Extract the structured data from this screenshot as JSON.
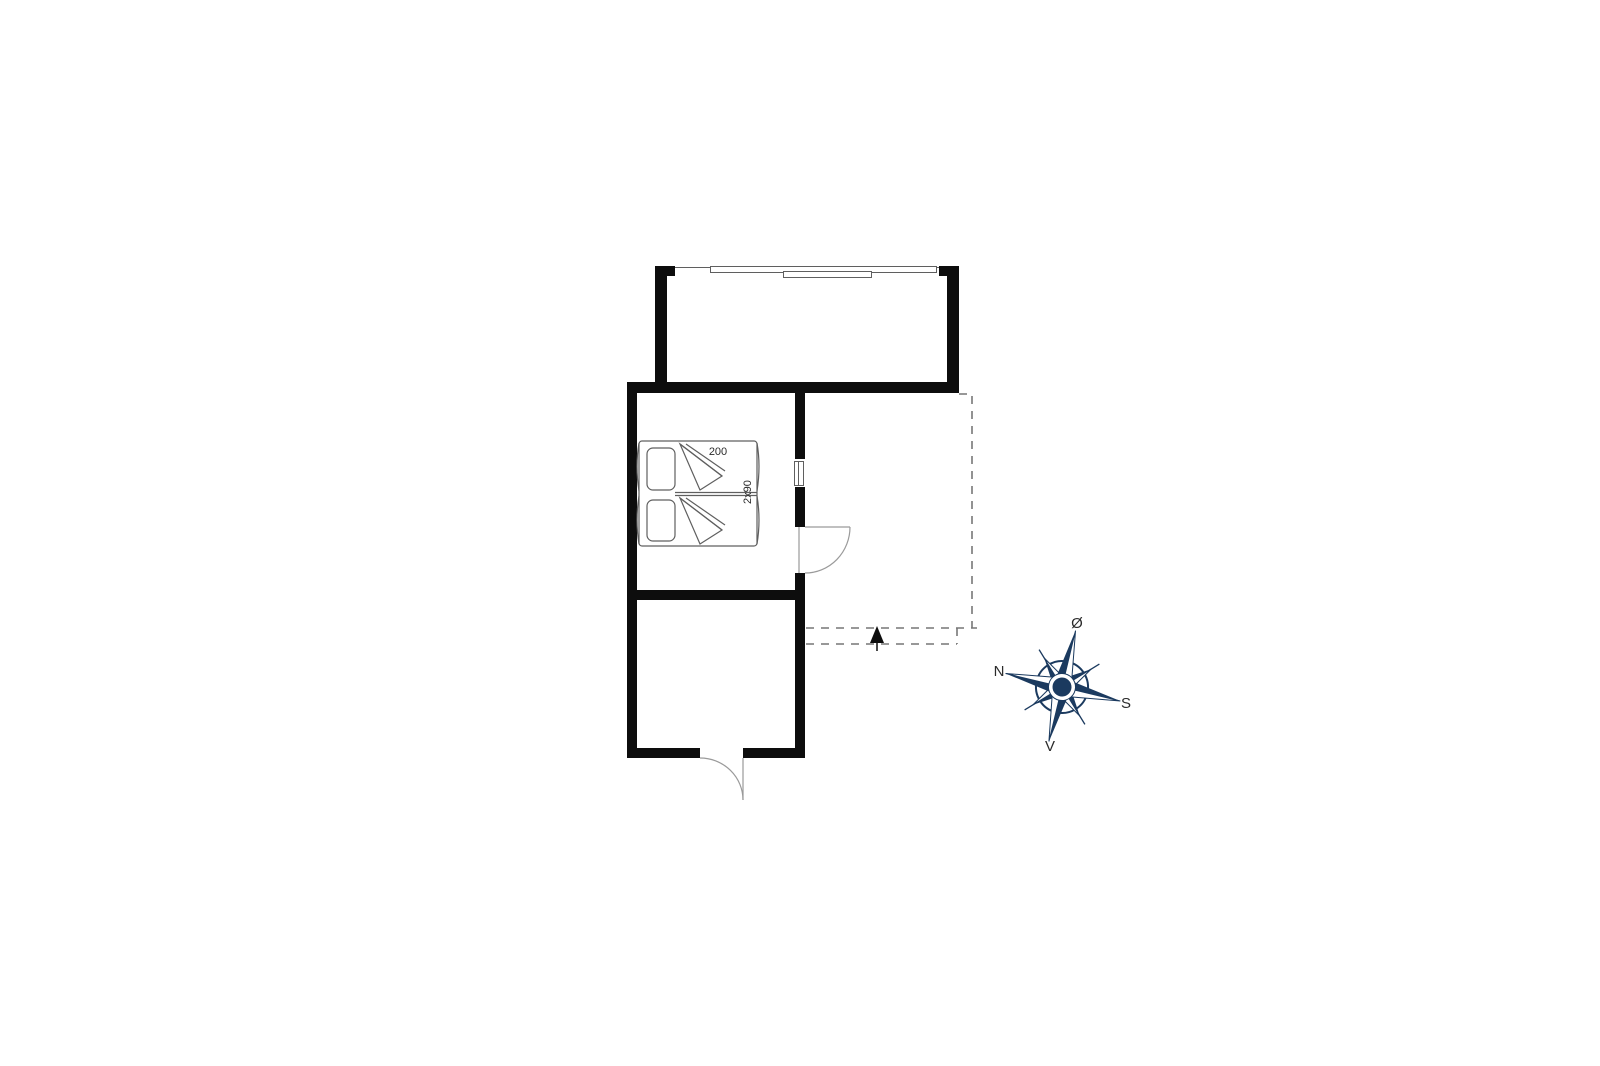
{
  "colors": {
    "background": "#ffffff",
    "wall": "#0d0d0d",
    "line": "#5f5f5f",
    "light-line": "#9a9a9a",
    "dashed": "#777777",
    "compass": "#1b3a5f",
    "text": "#2b2b2b"
  },
  "plan": {
    "bed": {
      "length_label": "200",
      "width_label": "2x90"
    },
    "compass": {
      "east_label": "Ø",
      "north_label": "N",
      "south_label": "S",
      "west_label": "V"
    }
  }
}
